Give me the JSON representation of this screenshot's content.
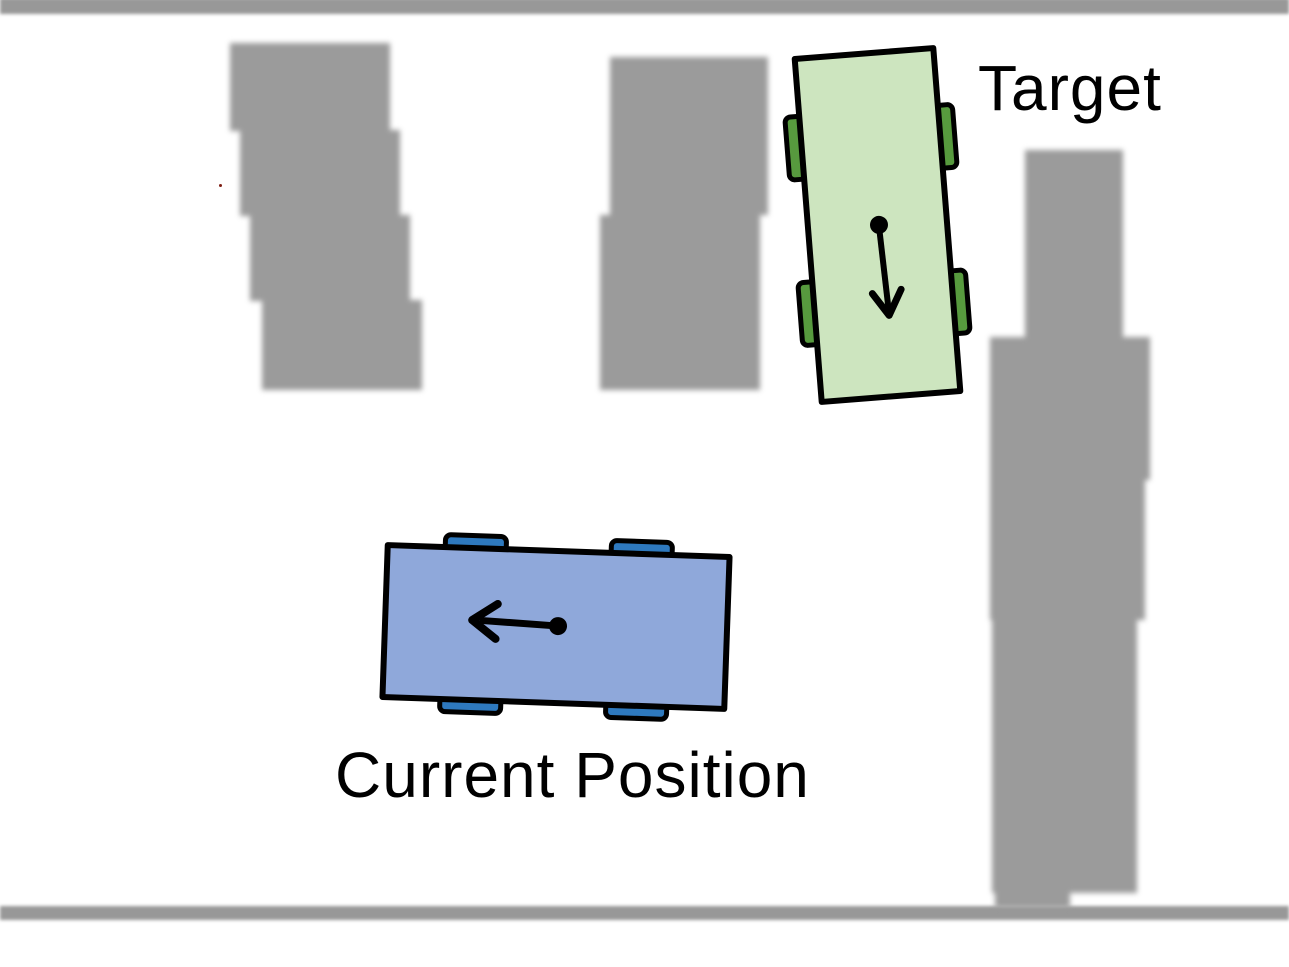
{
  "figure": {
    "type": "parking-scenario-diagram",
    "labels": {
      "target": "Target",
      "current_position": "Current Position"
    },
    "colors": {
      "background": "#ffffff",
      "wall": "#989898",
      "obstacle": "#9b9b9b",
      "target_body": "#cde5bf",
      "target_wheel": "#579a3e",
      "current_body": "#8fa8da",
      "current_wheel": "#2e79be",
      "outline": "#000000",
      "text": "#000000",
      "red_marker": "#7e1e14"
    },
    "vehicles": [
      {
        "id": "target",
        "label": "Target",
        "heading": "down",
        "wheels": 4
      },
      {
        "id": "current",
        "label": "Current Position",
        "heading": "left",
        "wheels": 4
      }
    ],
    "obstacle_count": 3,
    "walls": [
      "top",
      "bottom"
    ]
  }
}
